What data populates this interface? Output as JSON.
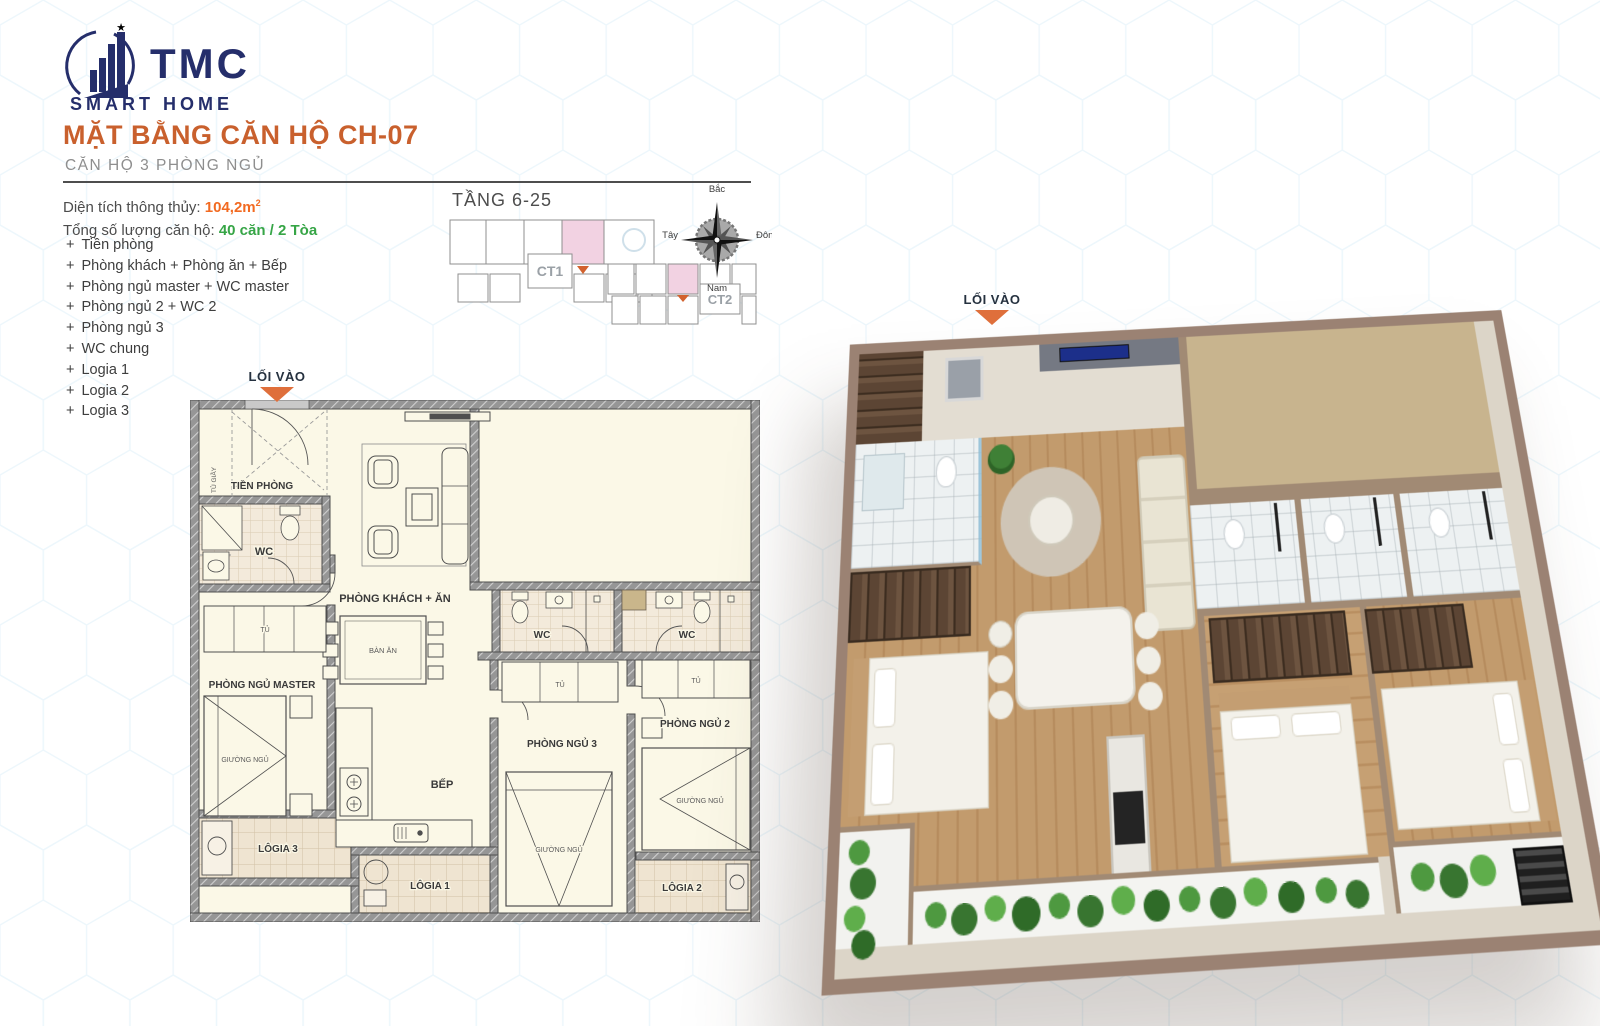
{
  "logo": {
    "text": "TMC",
    "subtext": "SMART HOME"
  },
  "header": {
    "title": "MẶT BẰNG CĂN HỘ CH-07",
    "subtitle": "CĂN HỘ 3 PHÒNG NGỦ"
  },
  "info": {
    "area_label": "Diện tích thông thủy:",
    "area_value": "104,2m",
    "area_sup": "2",
    "units_label": "Tổng số lượng căn hộ:",
    "units_value": "40 căn / 2 Tòa",
    "bullet": "+"
  },
  "room_list": [
    "Tiền phòng",
    "Phòng khách + Phòng ăn + Bếp",
    "Phòng ngủ master + WC master",
    "Phòng ngủ 2 + WC 2",
    "Phòng ngủ 3",
    "WC chung",
    "Logia 1",
    "Logia 2",
    "Logia 3"
  ],
  "keyplan": {
    "floors": "TẦNG 6-25",
    "tower1": "CT1",
    "tower2": "CT2"
  },
  "compass": {
    "north": "Bắc",
    "south": "Nam",
    "east": "Đông",
    "west": "Tây"
  },
  "plan": {
    "entry_label": "LỐI VÀO",
    "rooms": {
      "tien_phong": "TIỀN PHÒNG",
      "tu_giay": "TỦ GIẦY",
      "wc": "WC",
      "living": "PHÒNG KHÁCH + ĂN",
      "dining_table": "BÀN ĂN",
      "wardrobe": "TỦ",
      "master": "PHÒNG NGỦ MASTER",
      "bed": "GIƯỜNG NGỦ",
      "kitchen": "BẾP",
      "bedroom2": "PHÒNG NGỦ 2",
      "bedroom3": "PHÒNG NGỦ 3",
      "logia1": "LÔGIA 1",
      "logia2": "LÔGIA 2",
      "logia3": "LÔGIA 3"
    }
  },
  "colors": {
    "accent_orange": "#D2622E",
    "value_orange": "#F26A21",
    "value_green": "#36A546",
    "brand_navy": "#252E6B",
    "unit_highlight_pink": "#F2D2E2",
    "wall_gray": "#8F8F8F",
    "floor_cream": "#FBF8E7"
  }
}
